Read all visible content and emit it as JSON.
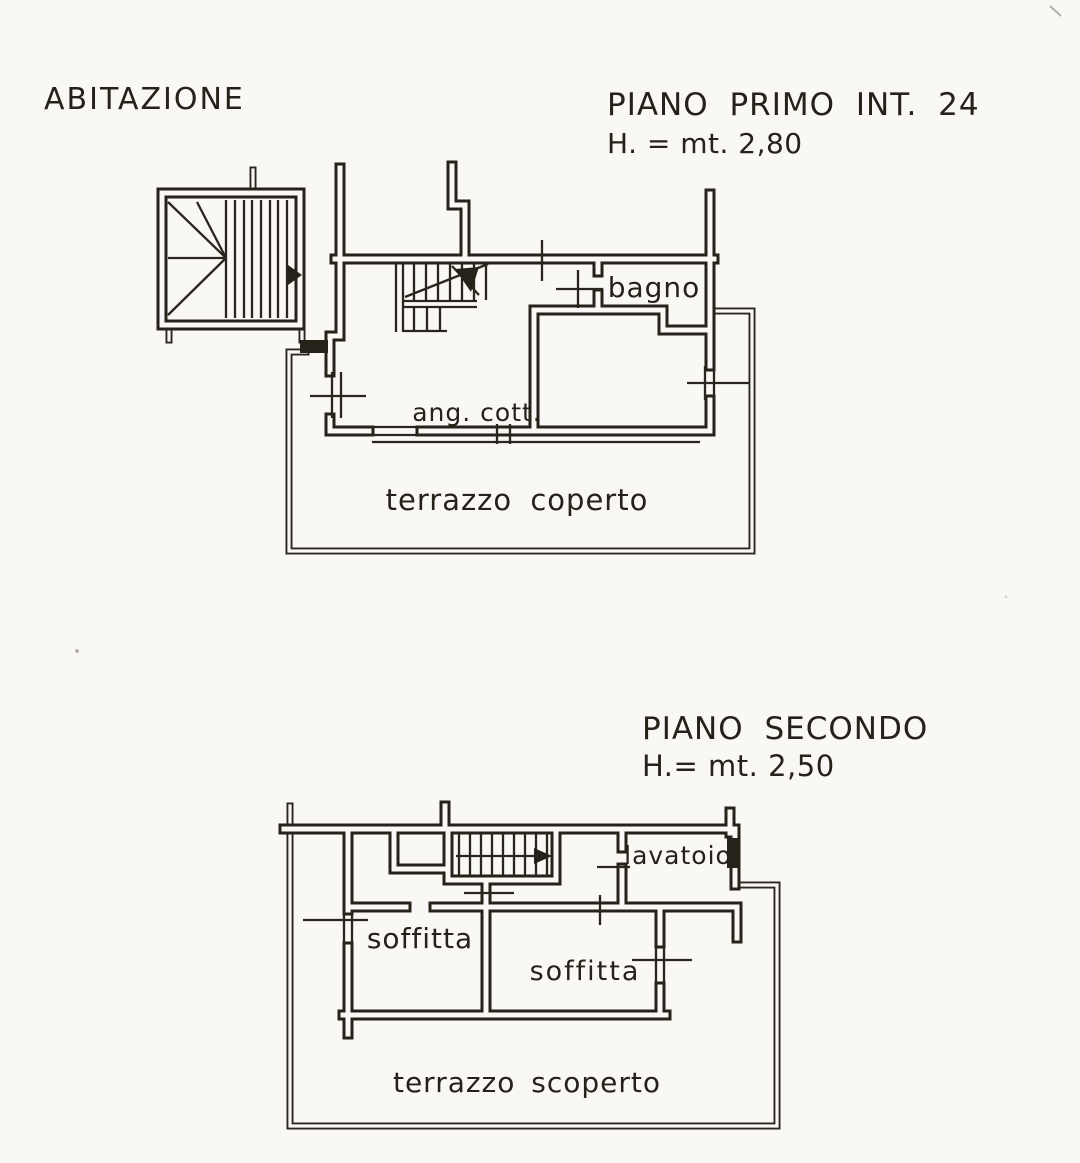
{
  "document": {
    "type_label": "ABITAZIONE",
    "paper_color": "#f9f8f5",
    "ink_color": "#262219"
  },
  "floors": [
    {
      "title": "PIANO PRIMO INT. 24",
      "height_note": "H. = mt. 2,80",
      "rooms": {
        "bathroom": "bagno",
        "kitchenette": "ang. cott.",
        "terrace": "terrazzo coperto"
      }
    },
    {
      "title": "PIANO SECONDO",
      "height_note": "H.= mt. 2,50",
      "rooms": {
        "laundry": "lavatoio",
        "attic_left": "soffitta",
        "attic_center": "soffitta",
        "terrace": "terrazzo scoperto"
      }
    }
  ]
}
